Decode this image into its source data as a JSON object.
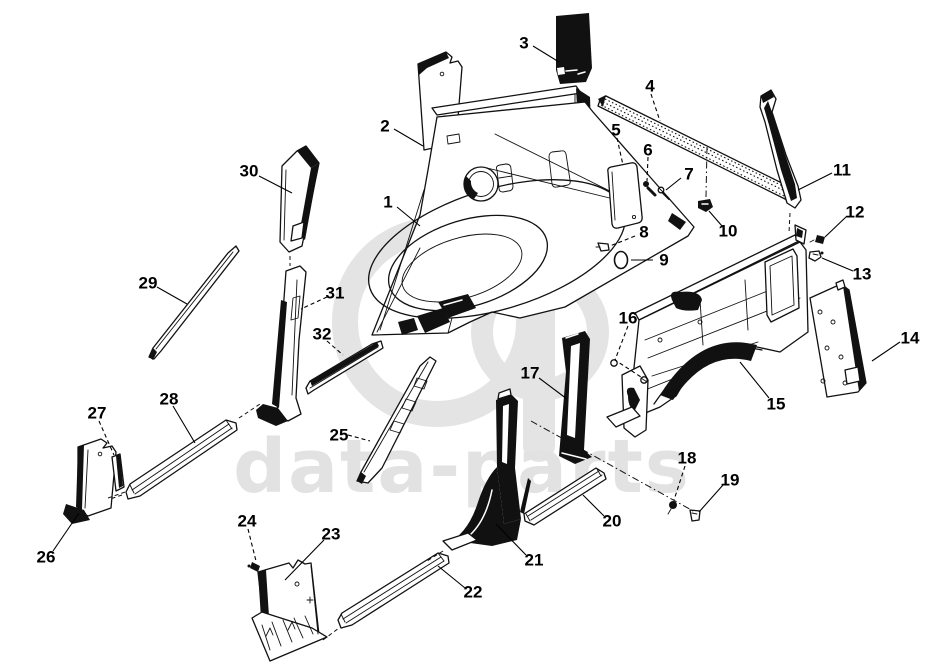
{
  "canvas": {
    "width": 928,
    "height": 670,
    "background": "#ffffff"
  },
  "watermark": {
    "text": "data-parts",
    "text_color": "#e2e2e2",
    "monogram_color": "#e4e4e4"
  },
  "diagram": {
    "type": "exploded-parts-diagram",
    "line_color": "#111111",
    "callouts": [
      {
        "n": "1",
        "x": 388,
        "y": 202,
        "dashed": false,
        "leader": [
          [
            397,
            207
          ],
          [
            420,
            226
          ]
        ]
      },
      {
        "n": "2",
        "x": 385,
        "y": 126,
        "dashed": false,
        "leader": [
          [
            394,
            129
          ],
          [
            423,
            146
          ]
        ]
      },
      {
        "n": "3",
        "x": 524,
        "y": 43,
        "dashed": false,
        "leader": [
          [
            533,
            46
          ],
          [
            559,
            62
          ]
        ]
      },
      {
        "n": "4",
        "x": 650,
        "y": 86,
        "dashed": true,
        "leader": [
          [
            651,
            94
          ],
          [
            660,
            121
          ]
        ]
      },
      {
        "n": "5",
        "x": 616,
        "y": 130,
        "dashed": true,
        "leader": [
          [
            617,
            138
          ],
          [
            623,
            165
          ]
        ]
      },
      {
        "n": "6",
        "x": 648,
        "y": 150,
        "dashed": true,
        "leader": [
          [
            648,
            157
          ],
          [
            647,
            181
          ]
        ]
      },
      {
        "n": "7",
        "x": 689,
        "y": 174,
        "dashed": false,
        "leader": [
          [
            681,
            178
          ],
          [
            666,
            190
          ]
        ]
      },
      {
        "n": "8",
        "x": 644,
        "y": 232,
        "dashed": true,
        "leader": [
          [
            635,
            236
          ],
          [
            610,
            246
          ]
        ]
      },
      {
        "n": "9",
        "x": 664,
        "y": 260,
        "dashed": false,
        "leader": [
          [
            653,
            260
          ],
          [
            631,
            260
          ]
        ]
      },
      {
        "n": "10",
        "x": 728,
        "y": 231,
        "dashed": false,
        "leader": [
          [
            722,
            226
          ],
          [
            709,
            211
          ]
        ]
      },
      {
        "n": "11",
        "x": 842,
        "y": 170,
        "dashed": false,
        "leader": [
          [
            832,
            173
          ],
          [
            798,
            190
          ]
        ]
      },
      {
        "n": "12",
        "x": 855,
        "y": 212,
        "dashed": false,
        "leader": [
          [
            847,
            216
          ],
          [
            825,
            237
          ]
        ]
      },
      {
        "n": "13",
        "x": 862,
        "y": 274,
        "dashed": false,
        "leader": [
          [
            853,
            271
          ],
          [
            822,
            258
          ]
        ]
      },
      {
        "n": "14",
        "x": 910,
        "y": 338,
        "dashed": false,
        "leader": [
          [
            900,
            342
          ],
          [
            872,
            361
          ]
        ]
      },
      {
        "n": "15",
        "x": 776,
        "y": 404,
        "dashed": false,
        "leader": [
          [
            769,
            398
          ],
          [
            740,
            362
          ]
        ]
      },
      {
        "n": "16",
        "x": 628,
        "y": 318,
        "dashed": true,
        "leader": [
          [
            628,
            326
          ],
          [
            615,
            360
          ],
          [
            641,
            377
          ]
        ]
      },
      {
        "n": "17",
        "x": 530,
        "y": 373,
        "dashed": false,
        "leader": [
          [
            539,
            378
          ],
          [
            567,
            399
          ]
        ]
      },
      {
        "n": "18",
        "x": 687,
        "y": 458,
        "dashed": true,
        "leader": [
          [
            685,
            466
          ],
          [
            674,
            500
          ]
        ]
      },
      {
        "n": "19",
        "x": 730,
        "y": 480,
        "dashed": false,
        "leader": [
          [
            723,
            485
          ],
          [
            699,
            512
          ]
        ]
      },
      {
        "n": "20",
        "x": 612,
        "y": 521,
        "dashed": false,
        "leader": [
          [
            604,
            516
          ],
          [
            583,
            495
          ]
        ]
      },
      {
        "n": "21",
        "x": 534,
        "y": 560,
        "dashed": false,
        "leader": [
          [
            526,
            555
          ],
          [
            496,
            524
          ]
        ]
      },
      {
        "n": "22",
        "x": 473,
        "y": 592,
        "dashed": false,
        "leader": [
          [
            465,
            588
          ],
          [
            438,
            566
          ]
        ]
      },
      {
        "n": "23",
        "x": 331,
        "y": 534,
        "dashed": false,
        "leader": [
          [
            324,
            540
          ],
          [
            285,
            580
          ]
        ]
      },
      {
        "n": "24",
        "x": 247,
        "y": 521,
        "dashed": true,
        "leader": [
          [
            248,
            529
          ],
          [
            256,
            561
          ]
        ]
      },
      {
        "n": "25",
        "x": 339,
        "y": 435,
        "dashed": true,
        "leader": [
          [
            348,
            435
          ],
          [
            370,
            441
          ]
        ]
      },
      {
        "n": "26",
        "x": 46,
        "y": 557,
        "dashed": false,
        "leader": [
          [
            53,
            551
          ],
          [
            79,
            513
          ]
        ]
      },
      {
        "n": "27",
        "x": 97,
        "y": 413,
        "dashed": true,
        "leader": [
          [
            99,
            421
          ],
          [
            114,
            455
          ]
        ]
      },
      {
        "n": "28",
        "x": 169,
        "y": 399,
        "dashed": false,
        "leader": [
          [
            173,
            406
          ],
          [
            195,
            443
          ]
        ]
      },
      {
        "n": "29",
        "x": 148,
        "y": 283,
        "dashed": false,
        "leader": [
          [
            157,
            287
          ],
          [
            187,
            304
          ]
        ]
      },
      {
        "n": "30",
        "x": 249,
        "y": 171,
        "dashed": false,
        "leader": [
          [
            259,
            176
          ],
          [
            292,
            193
          ]
        ]
      },
      {
        "n": "31",
        "x": 335,
        "y": 293,
        "dashed": true,
        "leader": [
          [
            327,
            297
          ],
          [
            301,
            309
          ]
        ]
      },
      {
        "n": "32",
        "x": 322,
        "y": 334,
        "dashed": true,
        "leader": [
          [
            327,
            341
          ],
          [
            343,
            355
          ]
        ]
      }
    ]
  }
}
